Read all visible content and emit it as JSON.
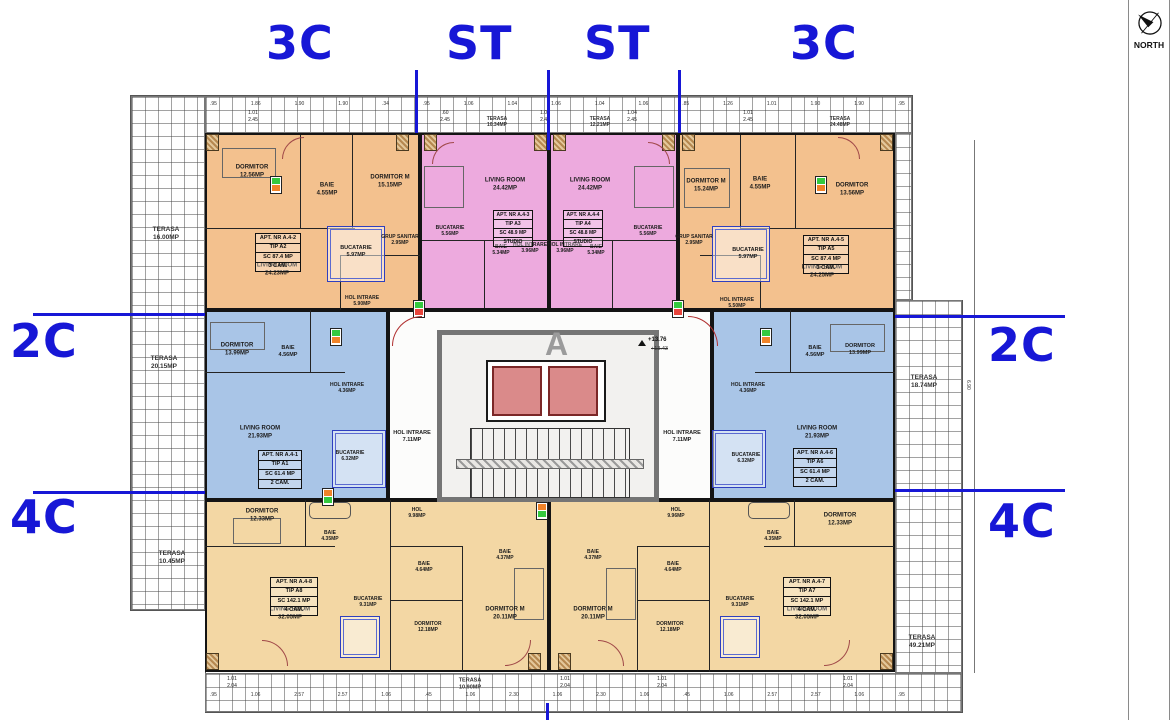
{
  "zones": {
    "top": [
      "3C",
      "ST",
      "ST",
      "3C"
    ],
    "left": [
      "2C",
      "4C"
    ],
    "right": [
      "2C",
      "4C"
    ]
  },
  "north_label": "NORTH",
  "core": {
    "watermark": "A",
    "level": "+13.76",
    "level_prev": "+13.43",
    "hall_left": "HOL INTRARE\n7.11MP",
    "hall_right": "HOL INTRARE\n7.11MP"
  },
  "terraces": [
    "TERASA\n16.00MP",
    "TERASA\n20.15MP",
    "TERASA\n10.45MP",
    "TERASA\n10.34MP",
    "TERASA\n12.21MP",
    "TERASA\n24.48MP",
    "TERASA\n18.74MP",
    "TERASA\n49.21MP",
    "TERASA\n10.90MP"
  ],
  "apartments": [
    {
      "box": [
        "APT. NR A.4-2",
        "TIP A2",
        "SC 87.4 MP",
        "3 CAM."
      ],
      "rooms": [
        "DORMITOR\n12.56MP",
        "BAIE\n4.55MP",
        "DORMITOR M\n15.15MP",
        "LIVING ROOM\n24.23MP",
        "BUCATARIE\n5.97MP",
        "GRUP SANITAR\n2.95MP",
        "HOL INTRARE\n5.90MP"
      ]
    },
    {
      "box": [
        "APT. NR A.4-3",
        "TIP A3",
        "SC 48.9 MP",
        "STUDIO"
      ],
      "rooms": [
        "LIVING ROOM\n24.42MP",
        "BUCATARIE\n5.56MP",
        "BAIE\n5.34MP",
        "HOL INTRARE\n3.96MP"
      ]
    },
    {
      "box": [
        "APT. NR A.4-4",
        "TIP A4",
        "SC 48.8 MP",
        "STUDIO"
      ],
      "rooms": [
        "LIVING ROOM\n24.42MP",
        "BUCATARIE\n5.56MP",
        "BAIE\n5.34MP",
        "HOL INTRARE\n3.96MP"
      ]
    },
    {
      "box": [
        "APT. NR A.4-5",
        "TIP A5",
        "SC 87.4 MP",
        "3 CAM."
      ],
      "rooms": [
        "DORMITOR M\n15.24MP",
        "BAIE\n4.55MP",
        "DORMITOR\n13.56MP",
        "LIVING ROOM\n24.25MP",
        "BUCATARIE\n5.97MP",
        "GRUP SANITAR\n2.95MP",
        "HOL INTRARE\n5.50MP"
      ]
    },
    {
      "box": [
        "APT. NR A.4-1",
        "TIP A1",
        "SC 61.4 MP",
        "2 CAM."
      ],
      "rooms": [
        "DORMITOR\n13.99MP",
        "BAIE\n4.56MP",
        "HOL INTRARE\n4.36MP",
        "LIVING ROOM\n21.93MP",
        "BUCATARIE\n6.32MP"
      ]
    },
    {
      "box": [
        "APT. NR A.4-6",
        "TIP A6",
        "SC 61.4 MP",
        "2 CAM."
      ],
      "rooms": [
        "BAIE\n4.56MP",
        "DORMITOR\n13.99MP",
        "HOL INTRARE\n4.36MP",
        "LIVING ROOM\n21.93MP",
        "BUCATARIE\n6.32MP"
      ]
    },
    {
      "box": [
        "APT. NR A.4-8",
        "TIP A8",
        "SC 142.1 MP",
        "4 CAM."
      ],
      "rooms": [
        "DORMITOR\n12.33MP",
        "BAIE\n4.35MP",
        "LIVING ROOM\n32.05MP",
        "BUCATARIE\n9.31MP",
        "HOL\n9.98MP",
        "BAIE\n4.64MP",
        "DORMITOR\n12.18MP",
        "BAIE\n4.37MP",
        "DORMITOR M\n20.11MP"
      ]
    },
    {
      "box": [
        "APT. NR A.4-7",
        "TIP A7",
        "SC 142.1 MP",
        "4 CAM."
      ],
      "rooms": [
        "BAIE\n4.37MP",
        "DORMITOR M\n20.11MP",
        "HOL\n9.96MP",
        "BAIE\n4.64MP",
        "DORMITOR\n12.18MP",
        "BUCATARIE\n9.31MP",
        "DORMITOR\n12.33MP",
        "BAIE\n4.35MP",
        "LIVING ROOM\n32.05MP"
      ]
    }
  ],
  "dims": {
    "top_numbers": [
      ".95",
      "1.86",
      "1.90",
      "1.90",
      ".34",
      ".95",
      "1.06",
      "1.04",
      "1.06",
      "1.04",
      "1.06",
      ".85",
      "1.26",
      "1.01",
      "1.90",
      "1.90",
      ".95"
    ],
    "bottom_numbers": [
      ".95",
      "1.06",
      "2.57",
      "2.57",
      "1.06",
      ".45",
      "1.06",
      "2.30",
      "1.06",
      "2.30",
      "1.06",
      ".45",
      "1.06",
      "2.57",
      "2.57",
      "1.06",
      ".95"
    ],
    "top_pairs": [
      "1.01\n2.45",
      ".60\n2.45",
      "1.01\n2.45",
      "1.04\n2.45",
      "1.01\n2.45"
    ],
    "bottom_pairs": [
      "1.01\n2.04",
      "1.01\n2.04",
      "1.01\n2.04",
      "1.01\n2.04"
    ],
    "side": "6.90"
  },
  "colors": {
    "zone_label": "#1717d6",
    "type_3c": "#f3c18e",
    "type_st": "#edaade",
    "type_2c": "#a9c5e7",
    "type_4c": "#f3d7a4",
    "elevator": "#da8a8a"
  }
}
